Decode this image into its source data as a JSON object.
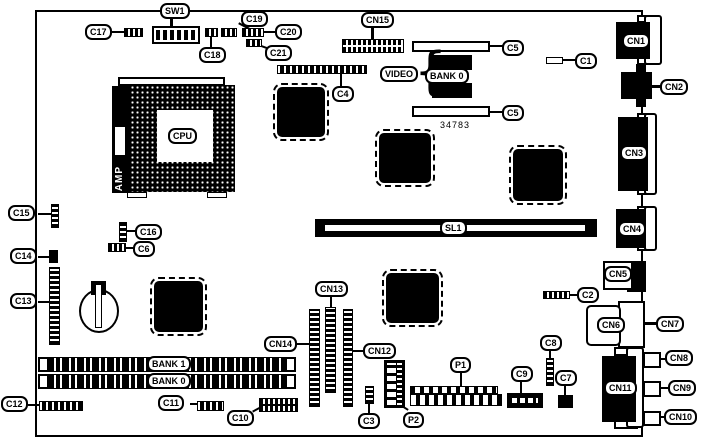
{
  "diagram_title": "motherboard-component-location-diagram",
  "part_number": "34783",
  "labels": {
    "sw1": "SW1",
    "c17": "C17",
    "c18": "C18",
    "c19": "C19",
    "c20": "C20",
    "c21": "C21",
    "cn15": "CN15",
    "c4": "C4",
    "c5": "C5",
    "c1": "C1",
    "video": "VIDEO",
    "bank0_video": "BANK 0",
    "cpu": "CPU",
    "amp": "AMP",
    "cn1": "CN1",
    "cn2": "CN2",
    "cn3": "CN3",
    "cn4": "CN4",
    "cn5": "CN5",
    "cn6": "CN6",
    "cn7": "CN7",
    "cn8": "CN8",
    "cn9": "CN9",
    "cn10": "CN10",
    "cn11": "CN11",
    "sl1": "SL1",
    "c15": "C15",
    "c16": "C16",
    "c6": "C6",
    "c14": "C14",
    "c13": "C13",
    "c12": "C12",
    "c2": "C2",
    "c3": "C3",
    "c7": "C7",
    "c8": "C8",
    "c9": "C9",
    "c10": "C10",
    "c11": "C11",
    "cn12": "CN12",
    "cn13": "CN13",
    "cn14": "CN14",
    "bank1_dimm": "BANK 1",
    "bank0_dimm": "BANK 0",
    "p1": "P1",
    "p2": "P2"
  }
}
